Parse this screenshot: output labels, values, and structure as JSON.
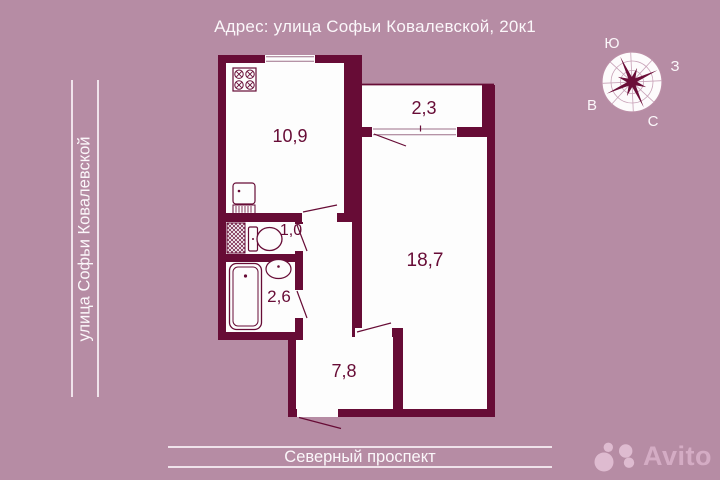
{
  "title": "Адрес: улица Софьи Ковалевской, 20к1",
  "streets": {
    "left": "улица Софьи Ковалевской",
    "bottom": "Северный проспект"
  },
  "compass": {
    "south": "Ю",
    "west": "З",
    "east": "В",
    "north": "С"
  },
  "floorplan": {
    "rooms": {
      "kitchen": "10,9",
      "balcony": "2,3",
      "wc": "1,0",
      "bathroom": "2,6",
      "living": "18,7",
      "hallway": "7,8"
    }
  },
  "watermark": {
    "brand": "Avito"
  },
  "colors": {
    "background": "#b68ca4",
    "wall": "#670c36",
    "road_line": "#f0e3eb",
    "watermark_pink": "#d8b0c8"
  }
}
